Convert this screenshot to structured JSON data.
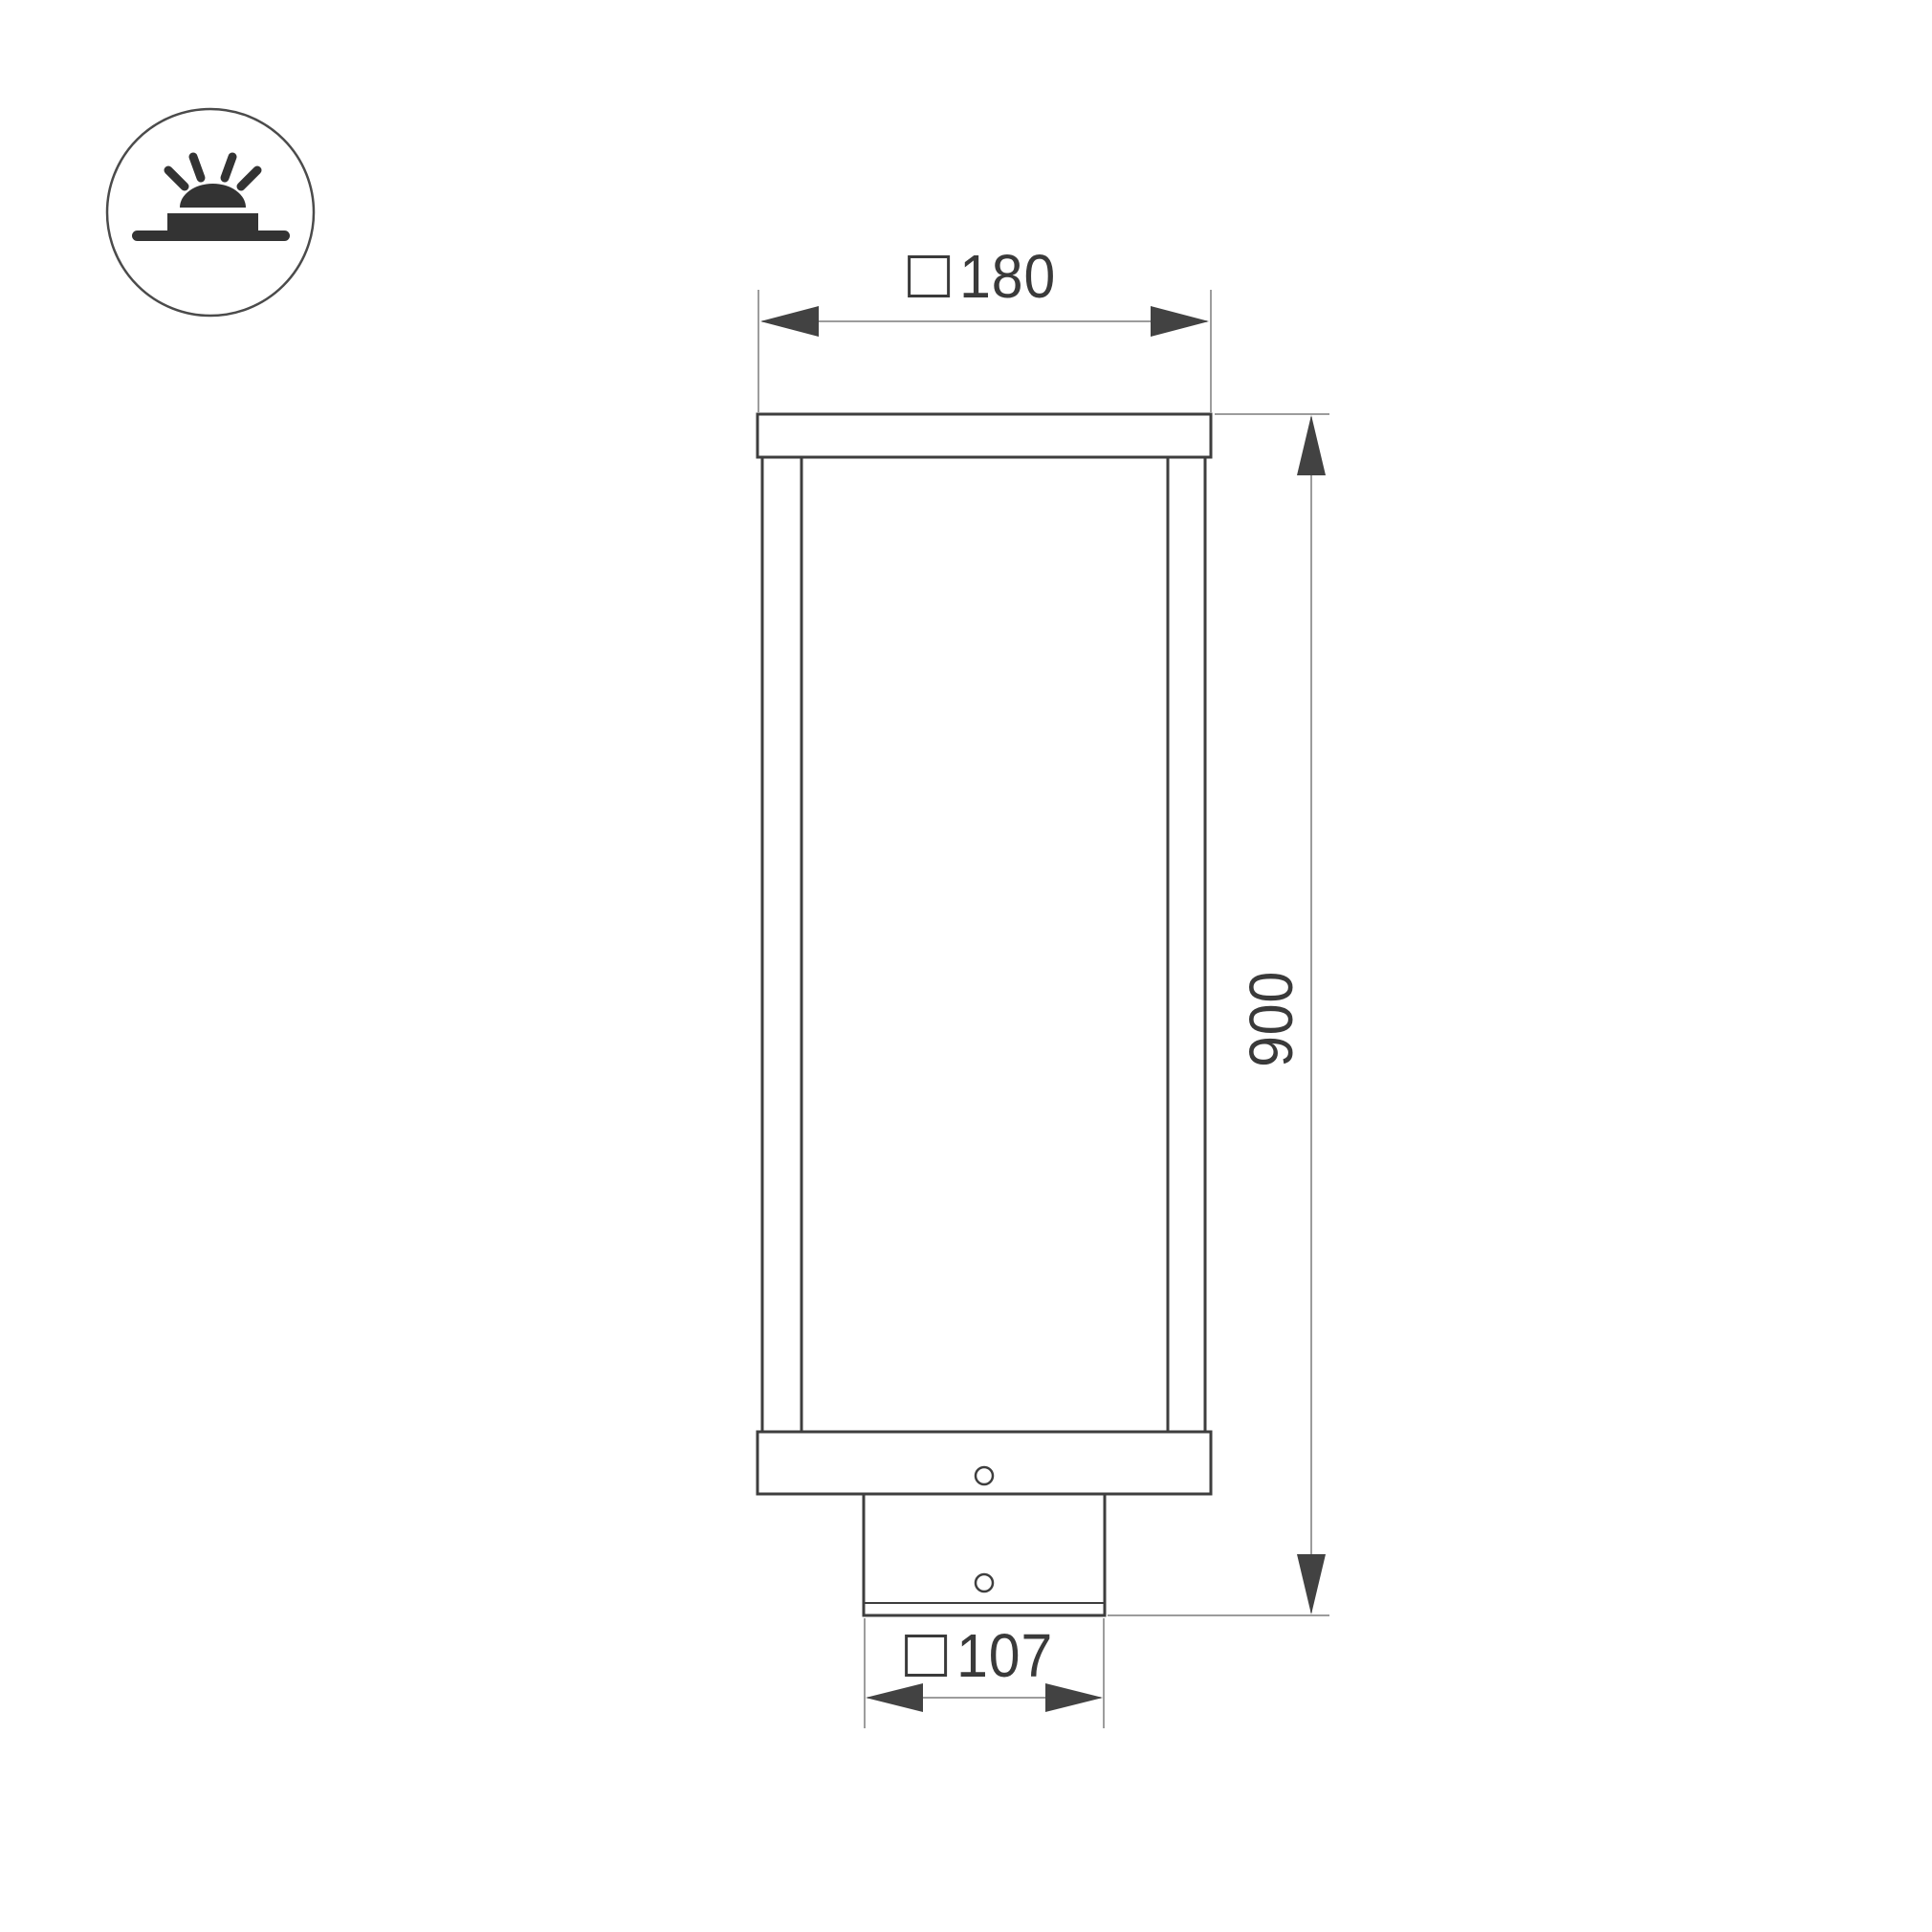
{
  "figure": {
    "kind": "technical-dimension-drawing"
  },
  "icon": {
    "name": "surface-mounted-light-icon"
  },
  "dimensions": {
    "top_width": {
      "symbol": "□",
      "value": "180"
    },
    "height": {
      "value": "900"
    },
    "base_width": {
      "symbol": "□",
      "value": "107"
    }
  },
  "colors": {
    "background": "#ffffff",
    "outline": "#3e3e3e",
    "dimension_line": "#7c7c7c",
    "arrow": "#424242",
    "text": "#3a3a3a",
    "icon": "#333333",
    "icon_circle": "#4b4b4b"
  }
}
